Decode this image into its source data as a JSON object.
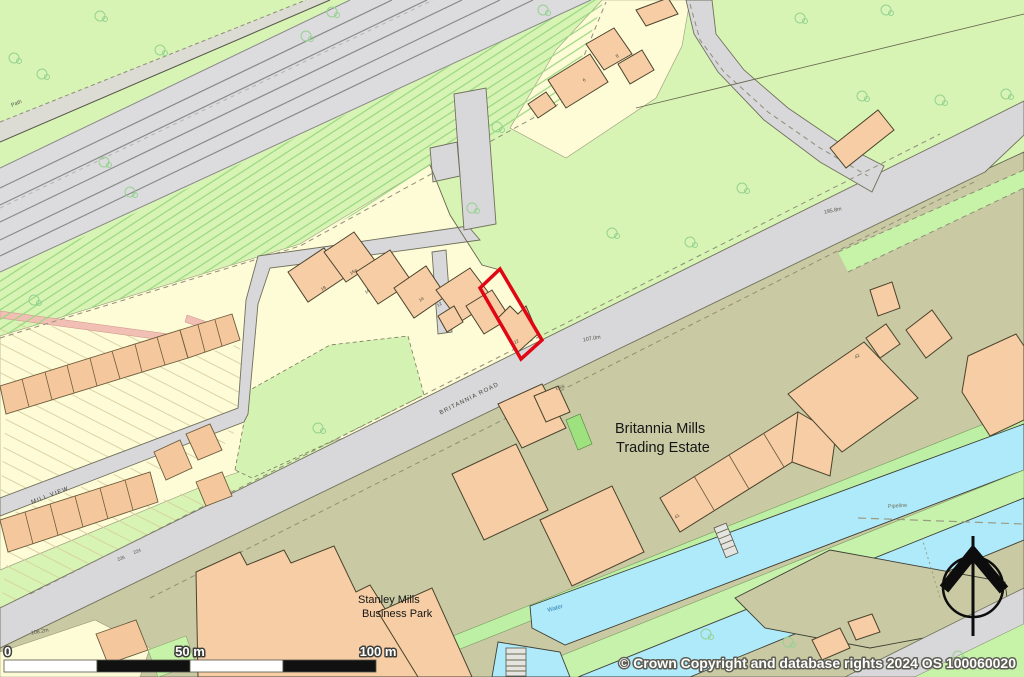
{
  "attribution": "© Crown Copyright and database rights 2024 OS 100060020",
  "scale_bar": {
    "tick0": "0",
    "tick50": "50 m",
    "tick100": "100 m"
  },
  "labels": {
    "estate_line1": "Britannia Mills",
    "estate_line2": "Trading Estate",
    "park_line1": "Stanley Mills",
    "park_line2": "Business Park",
    "road_main": "BRITANNIA ROAD",
    "road_side": "MILL VIEW",
    "water": "Water",
    "pipeline": "Pipeline",
    "path": "Path",
    "substation": "ESS",
    "plot_number": "22",
    "spot_heights": [
      "107.0m",
      "195.8m",
      "108.2m"
    ],
    "house_numbers": {
      "h6": "6",
      "h8": "8",
      "h12": "12",
      "h14": "14",
      "h16": "16",
      "h16a": "16a",
      "h18": "18",
      "h224": "224",
      "h226": "226",
      "h41": "41",
      "h42": "42"
    }
  },
  "colors": {
    "field_green": "#d7f4b5",
    "yard_olive": "#c9c9a4",
    "garden_cream": "#fefbd7",
    "building_peach": "#f6cda5",
    "road_grey": "#d8d7d9",
    "water_cyan": "#aeeafa",
    "plot_outline_red": "#e10613",
    "path_pink": "#f2bfb4"
  }
}
